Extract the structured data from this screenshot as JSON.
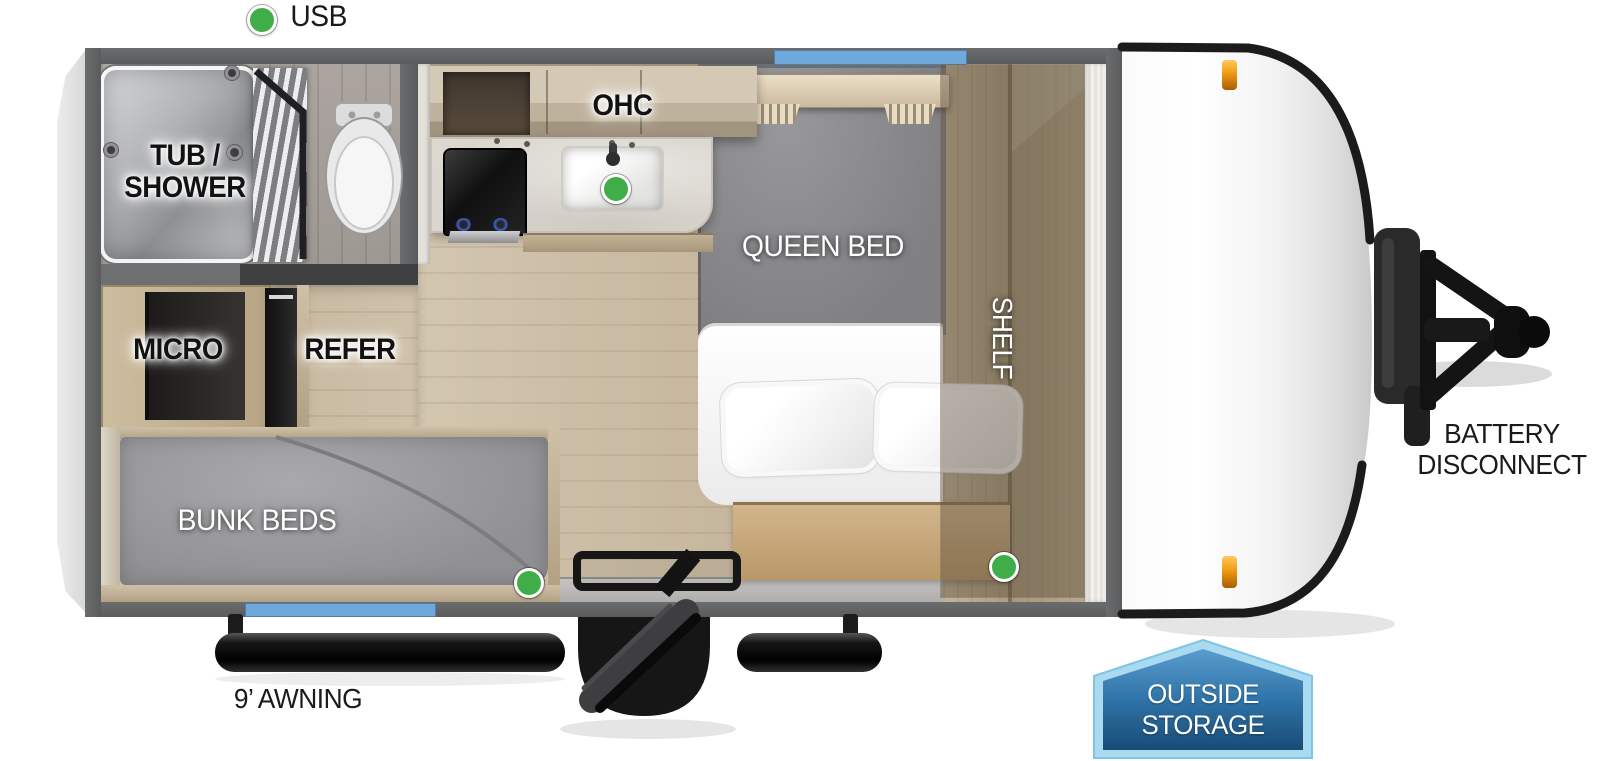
{
  "title": "Travel trailer floor plan",
  "legend": {
    "usb": "USB"
  },
  "labels": {
    "tub_shower_line1": "TUB /",
    "tub_shower_line2": "SHOWER",
    "ohc": "OHC",
    "queen_bed": "QUEEN BED",
    "shelf": "SHELF",
    "micro": "MICRO",
    "refer": "REFER",
    "bunk_beds": "BUNK BEDS",
    "awning": "9’ AWNING",
    "battery_line1": "BATTERY",
    "battery_line2": "DISCONNECT",
    "storage_line1": "OUTSIDE",
    "storage_line2": "STORAGE"
  },
  "colors": {
    "usb_indicator": "#3fae49",
    "window": "#6fa9dc",
    "wall": "#5a5b5c",
    "marker_light": "#ef9b13",
    "storage_badge_border": "#a9daf0",
    "storage_badge_fill": "#2f74a8"
  },
  "indicators": {
    "usb_locations": [
      "legend",
      "kitchen-sink",
      "bedroom-wardrobe",
      "bunk-foot"
    ]
  }
}
